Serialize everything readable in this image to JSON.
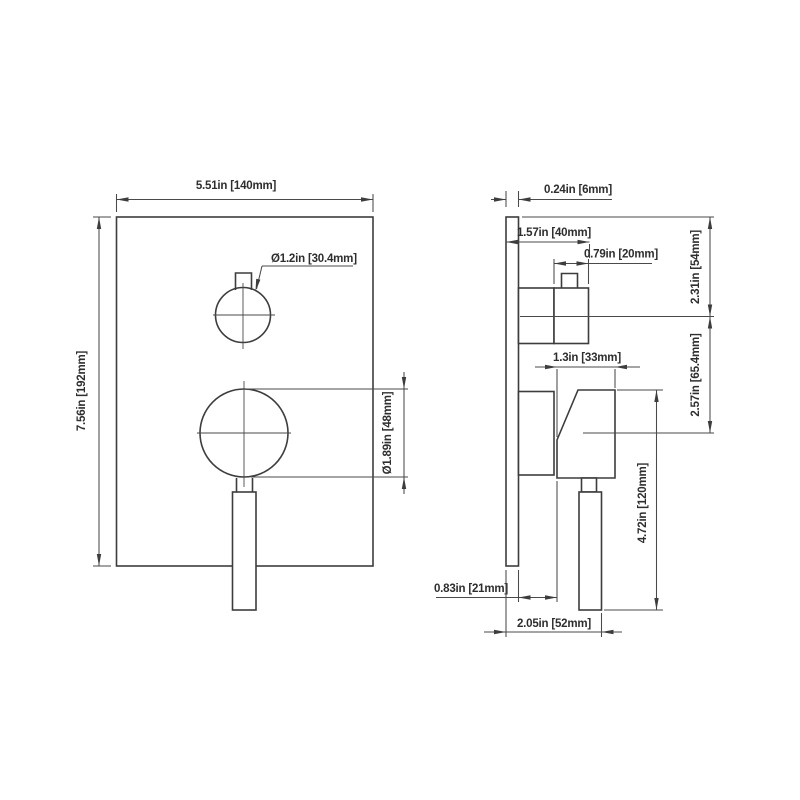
{
  "drawing": {
    "front_view": {
      "plate_width": "5.51in [140mm]",
      "plate_height": "7.56in [192mm]",
      "knob_diameter": "Ø1.2in [30.4mm]",
      "handle_hub_diameter": "Ø1.89in [48mm]"
    },
    "side_view": {
      "plate_thickness": "0.24in [6mm]",
      "knob_projection": "1.57in [40mm]",
      "knob_width": "0.79in [20mm]",
      "knob_center_from_top": "2.31in [54mm]",
      "lever_body_width": "1.3in [33mm]",
      "center_to_center": "2.57in [65.4mm]",
      "handle_length": "4.72in [120mm]",
      "lever_offset": "0.83in [21mm]",
      "handle_projection": "2.05in [52mm]"
    }
  }
}
